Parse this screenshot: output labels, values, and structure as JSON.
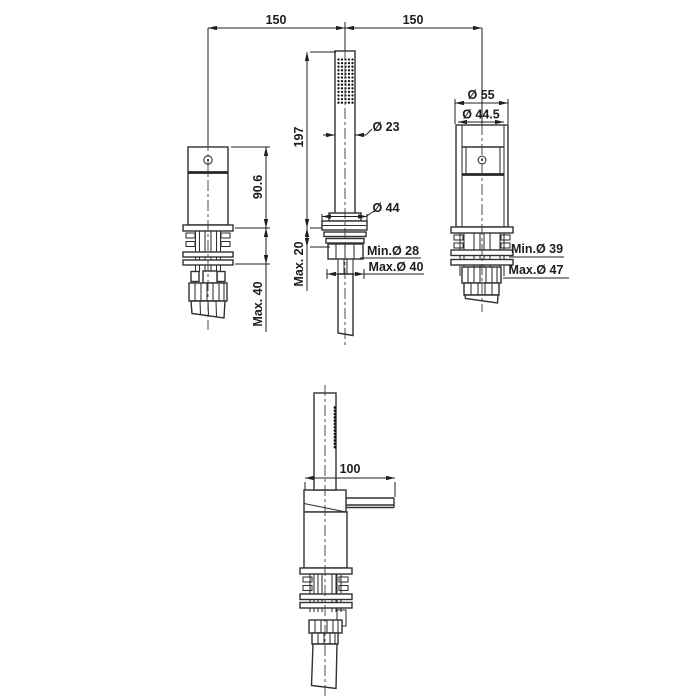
{
  "drawing": {
    "description": "deck-mounted bath mixer with hand shower - dimensional technical drawing",
    "dims": {
      "left_spacing": "150",
      "right_spacing": "150",
      "handshower_length": "197",
      "handshower_dia": "Ø 23",
      "rosette_dia": "Ø 44",
      "hole_min_mid": "Min.Ø 28",
      "hole_max_mid": "Max.Ø 40",
      "deck_max_mid": "Max. 20",
      "valve_height": "90.6",
      "deck_max_left": "Max. 40",
      "body_dia_outer": "Ø 55",
      "body_dia_inner": "Ø 44.5",
      "hole_min_right": "Min.Ø 39",
      "hole_max_right": "Max.Ø 47",
      "spout_reach": "100"
    },
    "line_color": "#303030",
    "text_color": "#1d1d1d",
    "background": "#ffffff"
  }
}
